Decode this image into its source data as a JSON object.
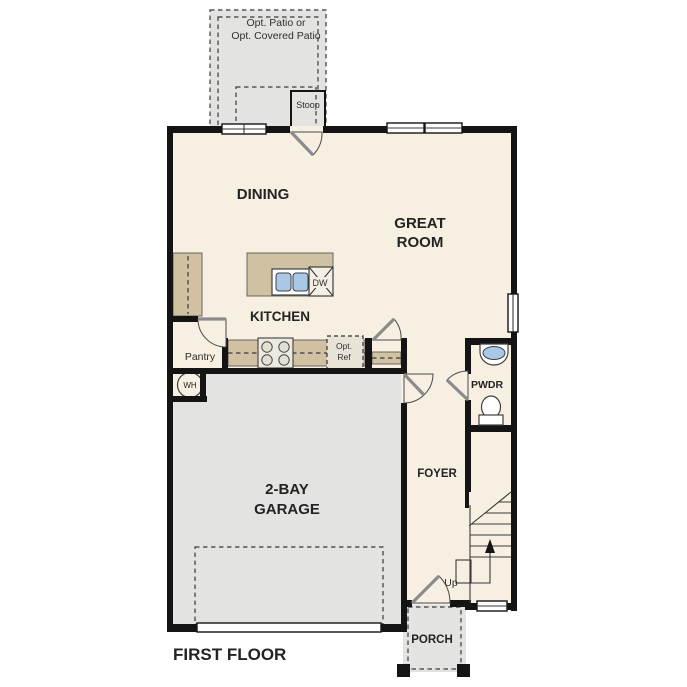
{
  "title": "FIRST FLOOR",
  "plan": {
    "patio_label": [
      "Opt. Patio or",
      "Opt. Covered Patio"
    ],
    "stoop": "Stoop",
    "dining": "DINING",
    "great_room": [
      "GREAT",
      "ROOM"
    ],
    "kitchen": "KITCHEN",
    "pantry": "Pantry",
    "opt_ref": [
      "Opt.",
      "Ref"
    ],
    "dw": "DW",
    "wh": "WH",
    "pwdr": "PWDR",
    "foyer": "FOYER",
    "garage": [
      "2-BAY",
      "GARAGE"
    ],
    "up": "Up",
    "porch": "PORCH"
  },
  "colors": {
    "wall": "#141414",
    "floor": "#f7efe1",
    "concrete": "#e3e3e1",
    "cabinet": "#d0c1a3",
    "fixture_blue": "#a9c8e8"
  }
}
